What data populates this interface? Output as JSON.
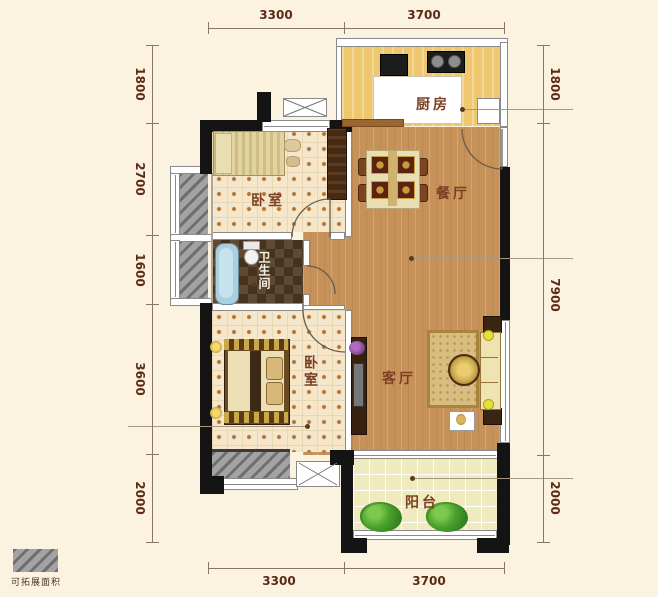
{
  "plan": {
    "rooms": {
      "kitchen": "厨房",
      "dining": "餐厅",
      "living": "客厅",
      "bedroom_top": "卧室",
      "bedroom_bottom": "卧室",
      "bathroom": "卫生间",
      "balcony": "阳台"
    },
    "legend": {
      "expandable_label": "可拓展面积"
    },
    "dimensions": {
      "top": [
        "3300",
        "3700"
      ],
      "bottom": [
        "3300",
        "3700"
      ],
      "left": [
        "1800",
        "2700",
        "1600",
        "3600",
        "2000"
      ],
      "right": [
        "1800",
        "7900",
        "2000"
      ]
    },
    "colors": {
      "background": "#fcf2e0",
      "wood_floor": "#c6925a",
      "kitchen_floor": "#efc76f",
      "tile_floor": "#f5e7cb",
      "bathroom_floor": "#54402c",
      "balcony_floor": "#f0ebbe",
      "wall_black": "#141414",
      "hatch_gray": "#9a9a9a",
      "dimension_text": "#5c2a16",
      "room_text": "#7b4023",
      "bathtub": "#aacfdf",
      "plant_green": "#4aa02c"
    }
  }
}
